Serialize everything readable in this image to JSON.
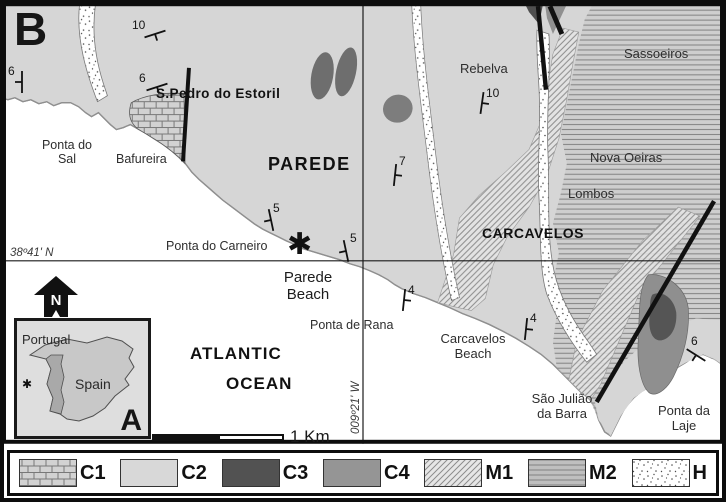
{
  "map_panel_label": "B",
  "inset_panel_label": "A",
  "graticule": {
    "parallel_label": "38º41' N",
    "meridian_label": "009º21' W"
  },
  "places": {
    "spedro": "S.Pedro do Estoril",
    "ponta_do_sal": "Ponta do\nSal",
    "bafureira": "Bafureira",
    "parede": "PAREDE",
    "ponta_do_carneiro": "Ponta do Carneiro",
    "parede_beach": "Parede\nBeach",
    "ponta_de_rana": "Ponta de Rana",
    "rebelva": "Rebelva",
    "sassoeiros": "Sassoeiros",
    "nova_oeiras": "Nova Oeiras",
    "lombos": "Lombos",
    "carcavelos": "CARCAVELOS",
    "carcavelos_beach": "Carcavelos\nBeach",
    "sao_juliao": "São Julião\nda Barra",
    "ponta_da_laje": "Ponta da\nLaje",
    "atlantic": "ATLANTIC",
    "ocean": "OCEAN"
  },
  "inset": {
    "portugal": "Portugal",
    "spain": "Spain"
  },
  "north_label": "N",
  "scale_label": "1 Km",
  "markers": {
    "site": "✱",
    "inset_site": "✱"
  },
  "dip_measurements": [
    "10",
    "6",
    "6",
    "5",
    "5",
    "10",
    "7",
    "4",
    "4",
    "6"
  ],
  "legend": {
    "items": [
      {
        "code": "C1",
        "pattern": "limestone-brick"
      },
      {
        "code": "C2",
        "pattern": "plain-light-gray"
      },
      {
        "code": "C3",
        "pattern": "plain-dark-gray"
      },
      {
        "code": "C4",
        "pattern": "plain-medium-gray"
      },
      {
        "code": "M1",
        "pattern": "diagonal-hatch"
      },
      {
        "code": "M2",
        "pattern": "horizontal-rule"
      },
      {
        "code": "H",
        "pattern": "stipple-dots"
      }
    ]
  },
  "colors": {
    "ocean": "#ffffff",
    "land_c2": "#d6d6d6",
    "c3_dark": "#525252",
    "c4_medium": "#959595",
    "frame": "#0d0d0d"
  }
}
